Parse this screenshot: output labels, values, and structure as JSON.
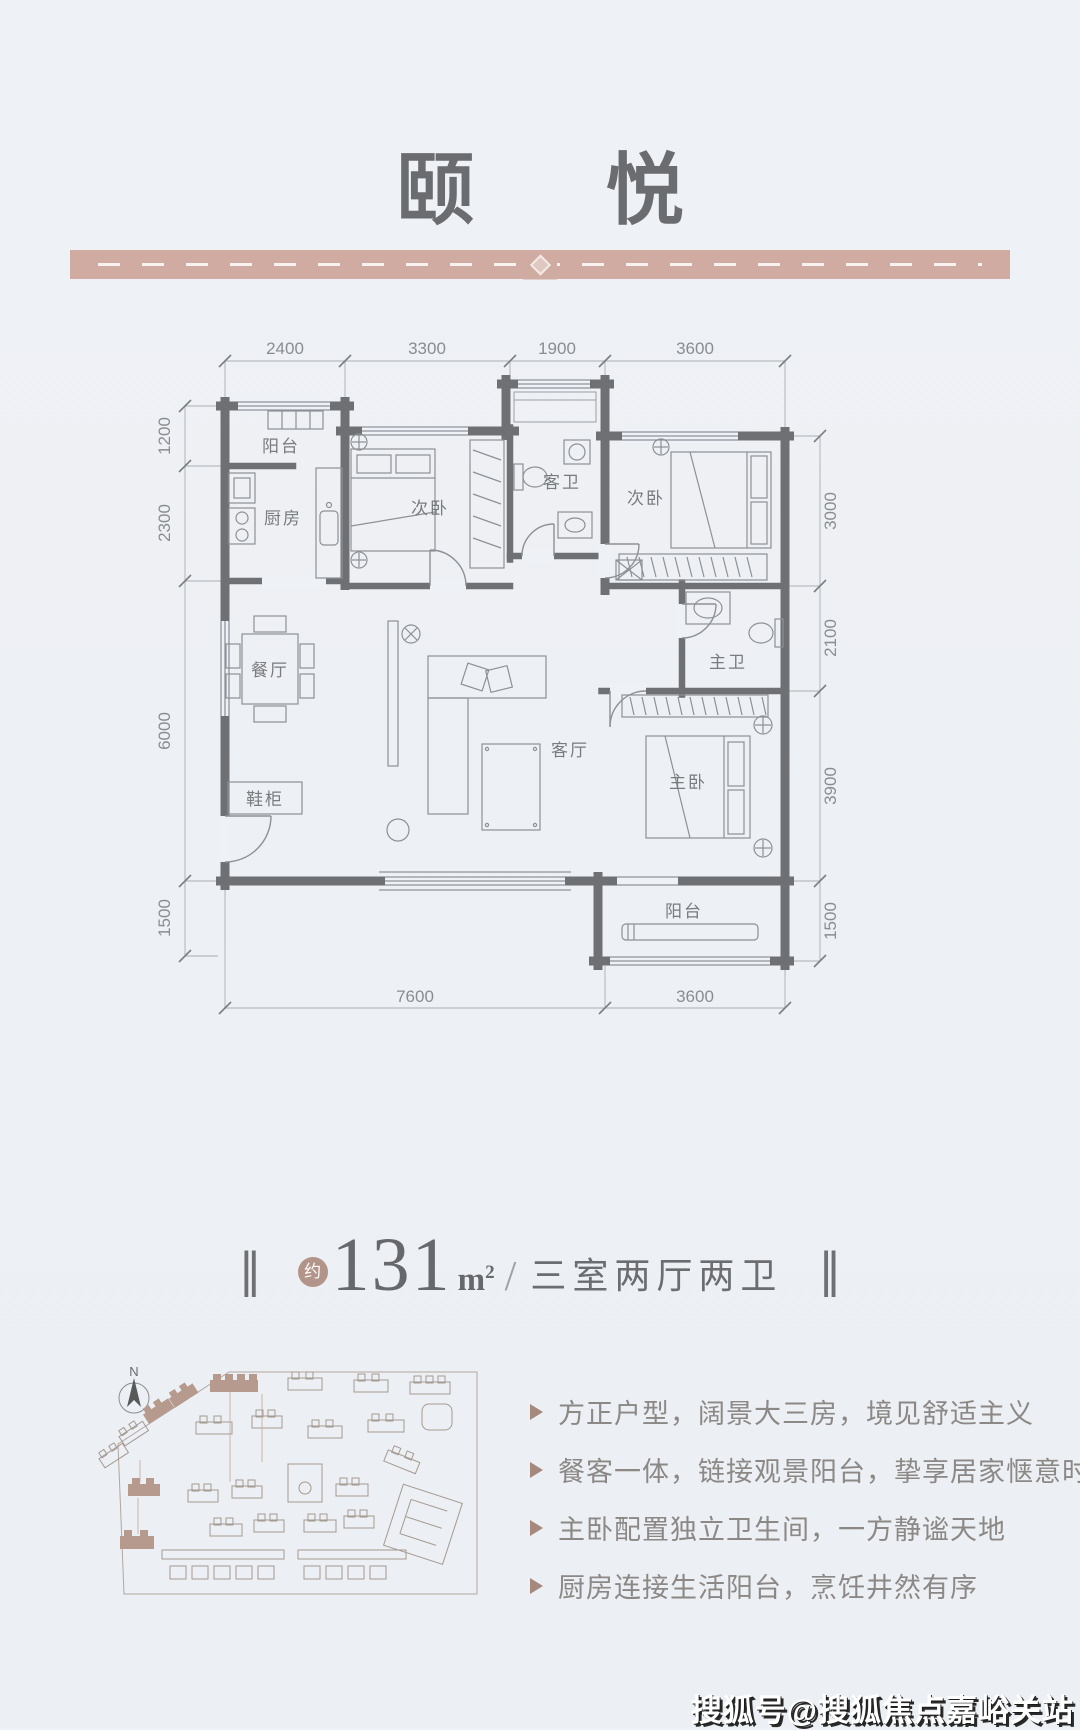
{
  "header": {
    "title": "颐 悦"
  },
  "area": {
    "bar": "‖",
    "approx": "约",
    "value": "131",
    "unit_base": "m",
    "unit_sup": "2",
    "divider": "/",
    "rooms_text": "三室两厅两卫"
  },
  "floor_plan": {
    "rooms": [
      {
        "name": "balcony-top",
        "label": "阳台"
      },
      {
        "name": "kitchen",
        "label": "厨房"
      },
      {
        "name": "bedroom-left",
        "label": "次卧"
      },
      {
        "name": "guest-bath",
        "label": "客卫"
      },
      {
        "name": "bedroom-right",
        "label": "次卧"
      },
      {
        "name": "dining",
        "label": "餐厅"
      },
      {
        "name": "master-bath",
        "label": "主卫"
      },
      {
        "name": "living",
        "label": "客厅"
      },
      {
        "name": "shoe-cabinet",
        "label": "鞋柜"
      },
      {
        "name": "master-bedroom",
        "label": "主卧"
      },
      {
        "name": "balcony-bottom",
        "label": "阳台"
      }
    ],
    "dimensions": {
      "top": [
        "2400",
        "3300",
        "1900",
        "3600"
      ],
      "left": [
        "1200",
        "2300",
        "6000",
        "1500"
      ],
      "right": [
        "3000",
        "2100",
        "3900",
        "1500"
      ],
      "bottom": [
        "7600",
        "3600"
      ]
    }
  },
  "site_plan": {
    "compass": "N"
  },
  "features": [
    "方正户型，阔景大三房，境见舒适主义",
    "餐客一体，链接观景阳台，挚享居家惬意时光",
    "主卧配置独立卫生间，一方静谧天地",
    "厨房连接生活阳台，烹饪井然有序"
  ],
  "watermark": {
    "text": "搜狐号@搜狐焦点嘉峪关站"
  },
  "colors": {
    "background": "#edf0f4",
    "band": "#d0aba1",
    "wall": "#6f7073",
    "line": "#8d9094",
    "dim_text": "#8a8d90",
    "title_text": "#6a6c6f",
    "badge": "#b3948a",
    "bullet_arrow": "#a5897c",
    "feature_text": "#8b8886"
  }
}
